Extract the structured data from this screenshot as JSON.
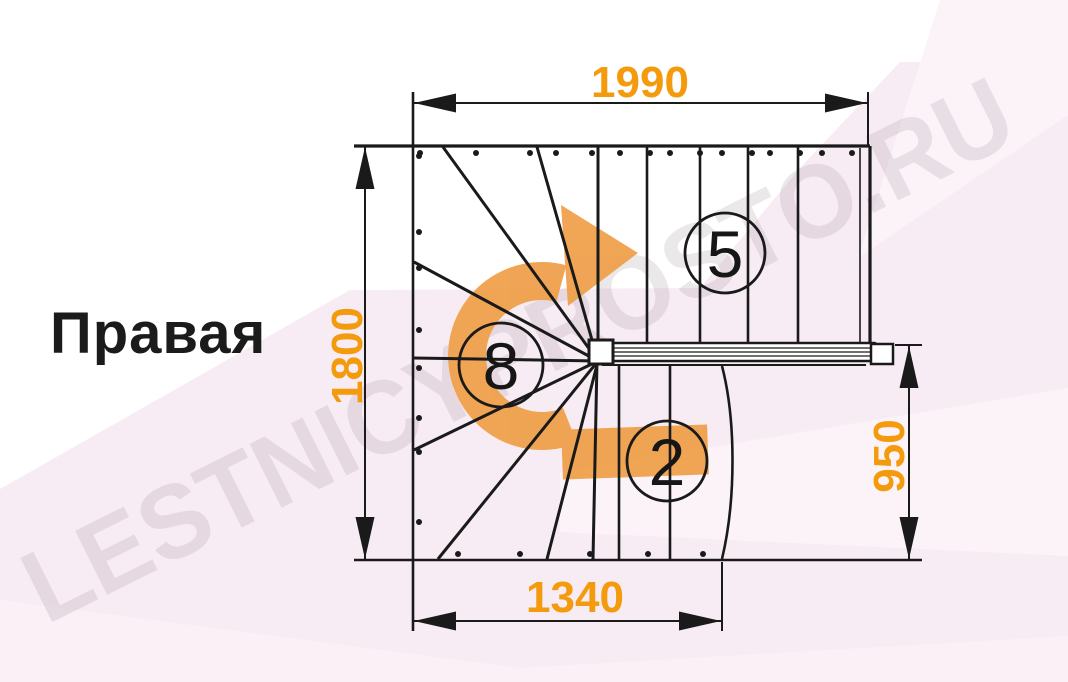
{
  "title": {
    "label": "Правая"
  },
  "watermark": {
    "text": "LESTNICYPROSTO.RU"
  },
  "dimensions": {
    "top": {
      "value": "1990"
    },
    "left": {
      "value": "1800"
    },
    "right": {
      "value": "950"
    },
    "bottom": {
      "value": "1340"
    }
  },
  "flights": {
    "upper": {
      "steps": "5"
    },
    "winder": {
      "steps": "8"
    },
    "lower": {
      "steps": "2"
    }
  },
  "icons": {
    "rotation_arrow": "curved-arrow-clockwise"
  },
  "colors": {
    "dimension_text": "#f49b0d",
    "rotation_arrow": "#efa14c",
    "linework": "#1a1a1a",
    "background_tint": "#f7ecf3"
  }
}
